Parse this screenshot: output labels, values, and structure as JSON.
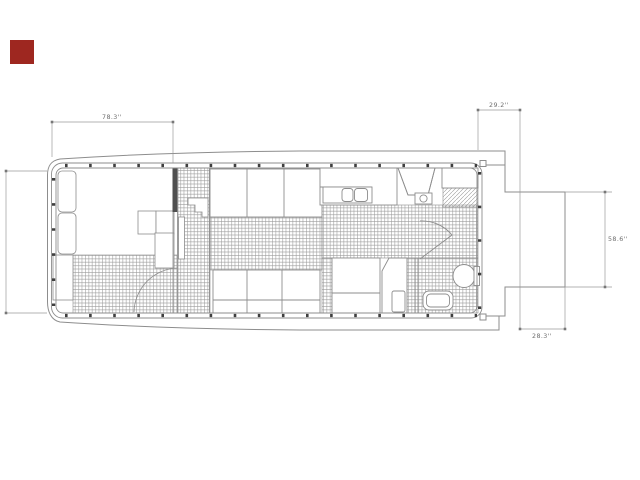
{
  "page": {
    "background": "#ffffff"
  },
  "marker": {
    "color": "#9e2720"
  },
  "drawing": {
    "line_color": "#8d8d8d",
    "wall_color": "#4f4f4f",
    "hatch_color": "#9b9b9b",
    "dimensions": {
      "bow_room_width": {
        "label": "78.3''"
      },
      "stern_deck_width": {
        "label": "29.2''"
      },
      "extension_height": {
        "label": "58.6''"
      },
      "extension_width": {
        "label": "28.3''"
      }
    }
  }
}
